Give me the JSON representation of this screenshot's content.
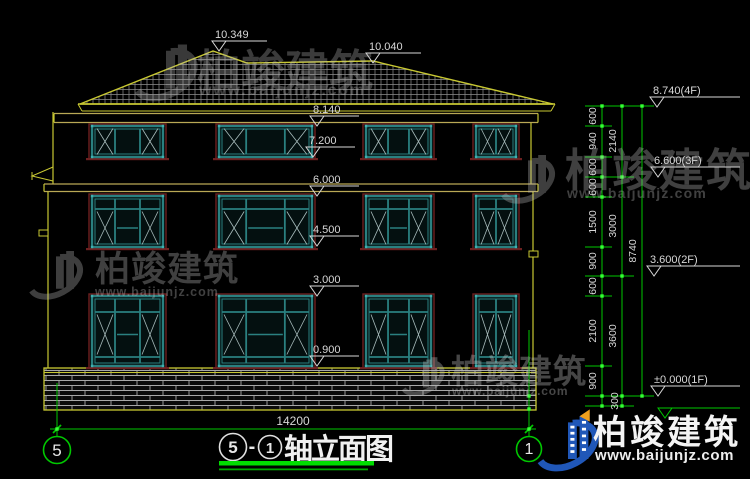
{
  "drawing": {
    "top_levels": [
      "10.349",
      "10.040"
    ],
    "facade_levels": [
      "8.140",
      "7.200",
      "6.000",
      "4.500",
      "3.000",
      "0.900"
    ],
    "right_levels": [
      "8.740(4F)",
      "6.600(3F)",
      "3.600(2F)",
      "±0.000(1F)"
    ],
    "chain_segments": [
      "600",
      "940",
      "600",
      "600",
      "1500",
      "900",
      "600",
      "2100",
      "900",
      "300"
    ],
    "chain_subtotals": [
      "2140",
      "3000",
      "3600"
    ],
    "chain_total": "8740",
    "overall_width": "14200",
    "axis_left": "5",
    "axis_right": "1",
    "title": {
      "num_left": "5",
      "dash": "-",
      "num_right": "1",
      "text": "轴立面图"
    }
  },
  "watermark": {
    "brand": "柏竣建筑",
    "url": "www.baijunjz.com"
  },
  "colors": {
    "line_yellow": "#c8c832",
    "band_tan": "#b9a855",
    "line_green": "#00c800",
    "grip_green": "#35ff35",
    "window_teal": "#2a8080",
    "surround_maroon": "#6e2020",
    "text_white": "#d8d8d8",
    "logo_blue": "#2057b8",
    "logo_yellow": "#f0a01e"
  }
}
